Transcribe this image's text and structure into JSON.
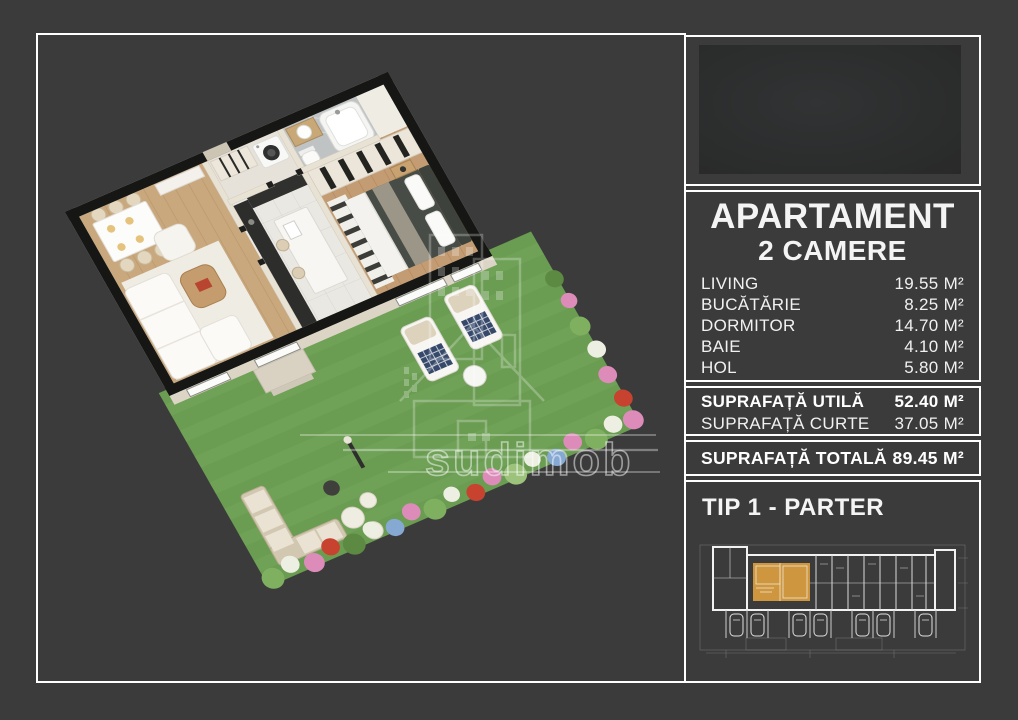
{
  "page": {
    "background_color": "#3b3b3b",
    "frame_color": "#ffffff"
  },
  "floor_plan": {
    "watermark_text": "sudimob",
    "grass_color": "#6a9c52",
    "scene": "3d-isometric-2-room-apartment-with-garden"
  },
  "info_panel": {
    "title": "APARTAMENT",
    "subtitle": "2 CAMERE",
    "rooms": [
      {
        "label": "LIVING",
        "value": "19.55 M²"
      },
      {
        "label": "BUCĂTĂRIE",
        "value": "8.25 M²"
      },
      {
        "label": "DORMITOR",
        "value": "14.70 M²"
      },
      {
        "label": "BAIE",
        "value": "4.10 M²"
      },
      {
        "label": "HOL",
        "value": "5.80 M²"
      }
    ]
  },
  "surface_panel": {
    "utila_label": "SUPRAFAȚĂ UTILĂ",
    "utila_value": "52.40 M²",
    "curte_label": "SUPRAFAȚĂ CURTE",
    "curte_value": "37.05 M²"
  },
  "total_panel": {
    "label": "SUPRAFAȚĂ TOTALĂ",
    "value": "89.45 M²"
  },
  "type_panel": {
    "title": "TIP 1 - PARTER",
    "highlight_color": "#d49a3f"
  }
}
